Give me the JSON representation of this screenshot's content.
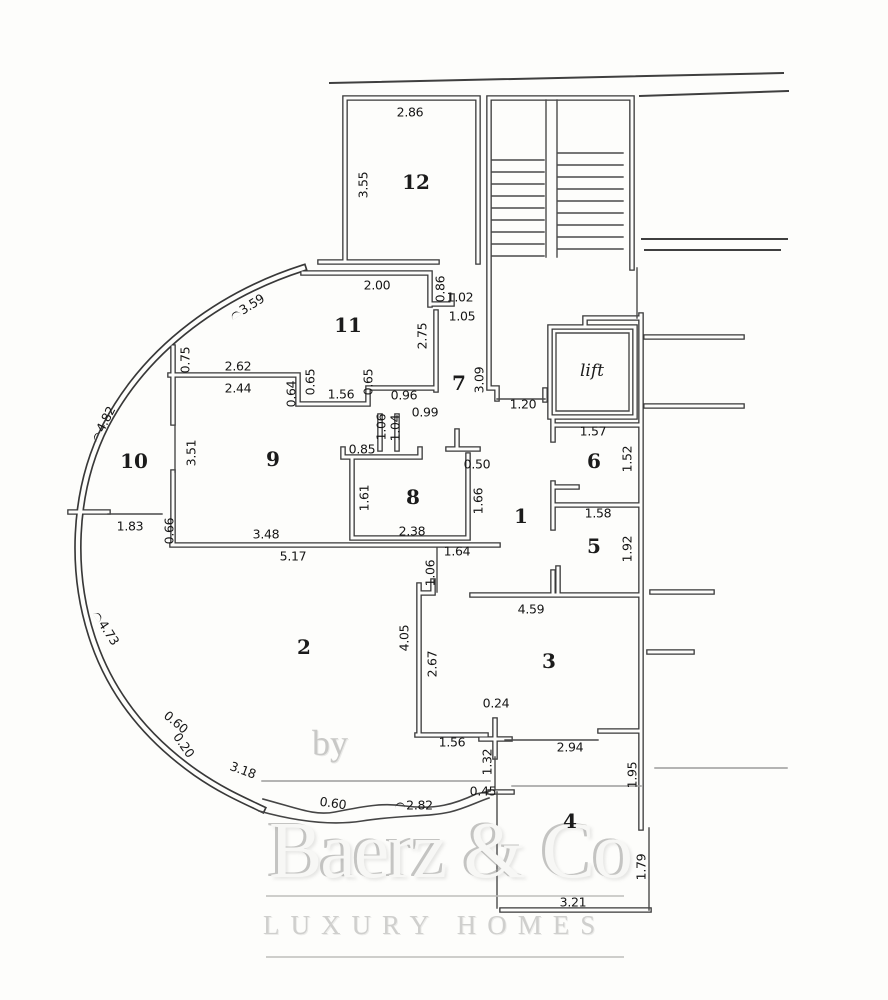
{
  "plan": {
    "rooms": [
      {
        "t": "12",
        "x": 416,
        "y": 182
      },
      {
        "t": "11",
        "x": 348,
        "y": 325
      },
      {
        "t": "7",
        "x": 459,
        "y": 383
      },
      {
        "t": "lift",
        "x": 592,
        "y": 371,
        "i": 1
      },
      {
        "t": "6",
        "x": 594,
        "y": 461
      },
      {
        "t": "10",
        "x": 134,
        "y": 461
      },
      {
        "t": "9",
        "x": 273,
        "y": 459
      },
      {
        "t": "8",
        "x": 413,
        "y": 497
      },
      {
        "t": "1",
        "x": 521,
        "y": 516
      },
      {
        "t": "5",
        "x": 594,
        "y": 546
      },
      {
        "t": "2",
        "x": 304,
        "y": 647
      },
      {
        "t": "3",
        "x": 549,
        "y": 661
      },
      {
        "t": "4",
        "x": 570,
        "y": 821
      }
    ],
    "dims": [
      {
        "t": "2.86",
        "x": 410,
        "y": 112
      },
      {
        "t": "3.55",
        "x": 363,
        "y": 185,
        "r": -90
      },
      {
        "t": "2.00",
        "x": 377,
        "y": 285
      },
      {
        "t": "0.86",
        "x": 440,
        "y": 289,
        "r": -90
      },
      {
        "t": "1.02",
        "x": 460,
        "y": 297
      },
      {
        "t": "1.05",
        "x": 462,
        "y": 316
      },
      {
        "t": "2.75",
        "x": 422,
        "y": 336,
        "r": -90
      },
      {
        "t": "3.59",
        "x": 247,
        "y": 307,
        "r": -32,
        "a": 1
      },
      {
        "t": "0.75",
        "x": 185,
        "y": 360,
        "r": -90
      },
      {
        "t": "2.62",
        "x": 238,
        "y": 366
      },
      {
        "t": "2.44",
        "x": 238,
        "y": 388
      },
      {
        "t": "0.64",
        "x": 291,
        "y": 394,
        "r": -90
      },
      {
        "t": "0.65",
        "x": 310,
        "y": 382,
        "r": -90
      },
      {
        "t": "1.56",
        "x": 341,
        "y": 394
      },
      {
        "t": "0.65",
        "x": 368,
        "y": 382,
        "r": -90
      },
      {
        "t": "0.96",
        "x": 404,
        "y": 395
      },
      {
        "t": "0.99",
        "x": 425,
        "y": 412
      },
      {
        "t": "1.06",
        "x": 381,
        "y": 427,
        "r": -90
      },
      {
        "t": "1.04",
        "x": 395,
        "y": 428,
        "r": -90
      },
      {
        "t": "3.09",
        "x": 479,
        "y": 380,
        "r": -90
      },
      {
        "t": "1.20",
        "x": 523,
        "y": 404
      },
      {
        "t": "1.57",
        "x": 593,
        "y": 431
      },
      {
        "t": "1.52",
        "x": 627,
        "y": 459,
        "r": -90
      },
      {
        "t": "4.82",
        "x": 103,
        "y": 424,
        "r": -63,
        "a": 1
      },
      {
        "t": "3.51",
        "x": 191,
        "y": 453,
        "r": -90
      },
      {
        "t": "0.85",
        "x": 362,
        "y": 449
      },
      {
        "t": "0.50",
        "x": 477,
        "y": 464
      },
      {
        "t": "1.66",
        "x": 478,
        "y": 501,
        "r": -90
      },
      {
        "t": "1.61",
        "x": 364,
        "y": 498,
        "r": -90
      },
      {
        "t": "2.38",
        "x": 412,
        "y": 531
      },
      {
        "t": "1.58",
        "x": 598,
        "y": 513
      },
      {
        "t": "1.83",
        "x": 130,
        "y": 526
      },
      {
        "t": "0.66",
        "x": 169,
        "y": 531,
        "r": -90
      },
      {
        "t": "3.48",
        "x": 266,
        "y": 534
      },
      {
        "t": "5.17",
        "x": 293,
        "y": 556
      },
      {
        "t": "1.64",
        "x": 457,
        "y": 551
      },
      {
        "t": "1.92",
        "x": 627,
        "y": 549,
        "r": -90
      },
      {
        "t": "1.06",
        "x": 430,
        "y": 573,
        "r": -90
      },
      {
        "t": "4.59",
        "x": 531,
        "y": 609
      },
      {
        "t": "4.73",
        "x": 106,
        "y": 628,
        "r": 57,
        "a": 1
      },
      {
        "t": "4.05",
        "x": 404,
        "y": 638,
        "r": -90
      },
      {
        "t": "2.67",
        "x": 432,
        "y": 664,
        "r": -90
      },
      {
        "t": "0.60",
        "x": 176,
        "y": 722,
        "r": 40
      },
      {
        "t": "0.20",
        "x": 184,
        "y": 745,
        "r": 55
      },
      {
        "t": "3.18",
        "x": 243,
        "y": 770,
        "r": 20
      },
      {
        "t": "0.24",
        "x": 496,
        "y": 703
      },
      {
        "t": "1.56",
        "x": 452,
        "y": 742
      },
      {
        "t": "2.94",
        "x": 570,
        "y": 747
      },
      {
        "t": "1.95",
        "x": 632,
        "y": 775,
        "r": -90
      },
      {
        "t": "1.32",
        "x": 487,
        "y": 762,
        "r": -90
      },
      {
        "t": "0.60",
        "x": 333,
        "y": 803,
        "r": 8
      },
      {
        "t": "2.82",
        "x": 414,
        "y": 805,
        "a": 1
      },
      {
        "t": "0.45",
        "x": 483,
        "y": 791
      },
      {
        "t": "1.79",
        "x": 641,
        "y": 867,
        "r": -90
      },
      {
        "t": "3.21",
        "x": 573,
        "y": 902
      }
    ],
    "colors": {
      "wall": "#383838",
      "thin": "#474747",
      "light": "#9b9b9b",
      "label": "#161616"
    }
  },
  "watermark": {
    "by": "by",
    "name": "Baerz & Co",
    "tagline": "LUXURY HOMES"
  }
}
